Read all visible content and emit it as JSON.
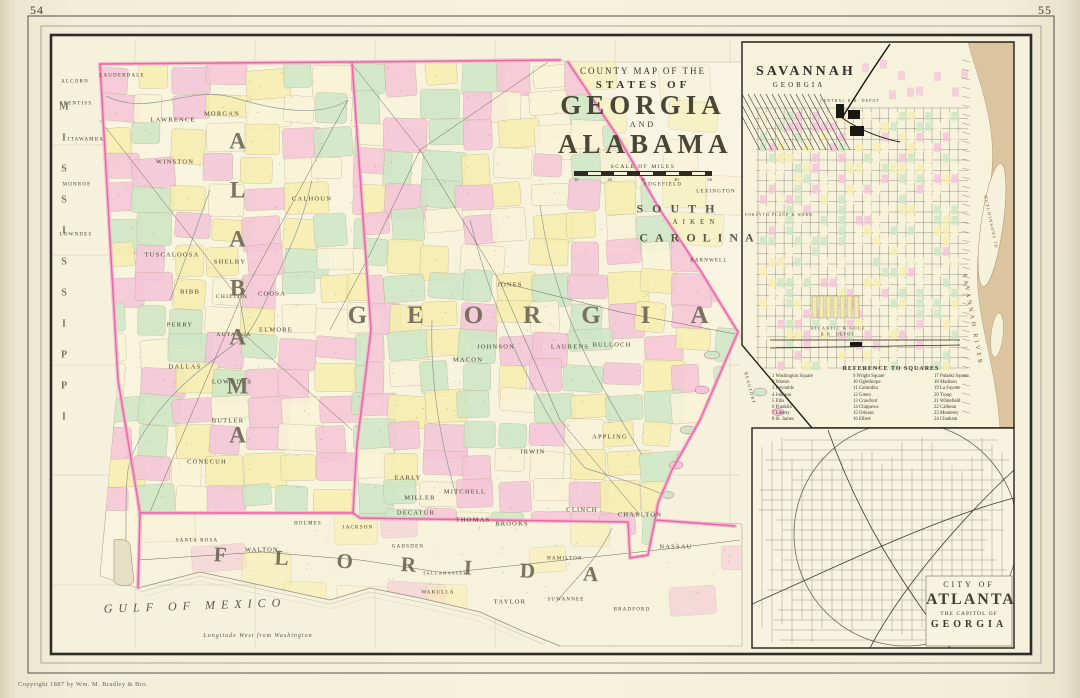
{
  "page": {
    "left_number": "54",
    "right_number": "55",
    "copyright": "Copyright 1887 by Wm. M. Bradley & Bro."
  },
  "title_block": {
    "kicker": "COUNTY MAP OF THE",
    "states_of": "STATES OF",
    "state1": "GEORGIA",
    "and_word": "AND",
    "state2": "ALABAMA",
    "scale_label": "SCALE OF MILES",
    "scale_ticks": [
      "10",
      "20",
      "30",
      "40",
      "50"
    ]
  },
  "savannah_inset": {
    "title": "SAVANNAH",
    "subtitle": "GEORGIA",
    "reference": {
      "title": "REFERENCE TO SQUARES",
      "columns": [
        [
          "1 Washington Square",
          "2 Warren",
          "3 Reynolds",
          "4 Johnson",
          "5 Ellis",
          "6 Franklin",
          "7 Liberty",
          "8 St. James"
        ],
        [
          "9 Wright Square",
          "10 Oglethorpe",
          "11 Columbia",
          "12 Green",
          "13 Crawford",
          "14 Chippewa",
          "15 Orleans",
          "16 Elbert"
        ],
        [
          "17 Pulaski Square",
          "18 Madison",
          "19 La Fayette",
          "20 Troup",
          "21 Whitefield",
          "22 Calhoun",
          "23 Monterey",
          "24 Chatham"
        ]
      ]
    }
  },
  "atlanta_inset": {
    "line1": "CITY OF",
    "line2": "ATLANTA",
    "line3": "THE CAPITOL OF",
    "line4": "GEORGIA"
  },
  "colors": {
    "state_border_core": "#e75f9f",
    "state_border_glow": "#f3b1cd",
    "county_pink": "#f4c6d8",
    "county_green": "#cfe7c6",
    "county_yellow": "#f6eeb0",
    "county_cream": "#f9f3d8",
    "paper": "#f6f1dc",
    "river_tan": "#d8bd95"
  },
  "labels": {
    "main": [
      {
        "t": "ALCORN",
        "x": 75,
        "y": 82,
        "fs": 5
      },
      {
        "t": "PRENTISS",
        "x": 76,
        "y": 104,
        "fs": 5
      },
      {
        "t": "ITAWAMBA",
        "x": 86,
        "y": 140,
        "fs": 5
      },
      {
        "t": "MONROE",
        "x": 77,
        "y": 185,
        "fs": 5
      },
      {
        "t": "LOWNDES",
        "x": 76,
        "y": 235,
        "fs": 5
      },
      {
        "t": "MISSISSIPPI",
        "x": 64,
        "y": 272,
        "fs": 10,
        "ls": 20,
        "cls": "vert state"
      },
      {
        "t": "LAUDERDALE",
        "x": 122,
        "y": 76,
        "fs": 5
      },
      {
        "t": "LAWRENCE",
        "x": 173,
        "y": 120
      },
      {
        "t": "MORGAN",
        "x": 222,
        "y": 114
      },
      {
        "t": "WINSTON",
        "x": 175,
        "y": 162
      },
      {
        "t": "CALHOUN",
        "x": 312,
        "y": 199
      },
      {
        "t": "TUSCALOOSA",
        "x": 172,
        "y": 255
      },
      {
        "t": "SHELBY",
        "x": 230,
        "y": 262
      },
      {
        "t": "BIBB",
        "x": 190,
        "y": 292
      },
      {
        "t": "COOSA",
        "x": 272,
        "y": 294
      },
      {
        "t": "CHILTON",
        "x": 232,
        "y": 297,
        "fs": 5.5
      },
      {
        "t": "PERRY",
        "x": 180,
        "y": 325
      },
      {
        "t": "AUTAUGA",
        "x": 234,
        "y": 335,
        "fs": 5.5
      },
      {
        "t": "ELMORE",
        "x": 276,
        "y": 330
      },
      {
        "t": "DALLAS",
        "x": 185,
        "y": 367
      },
      {
        "t": "LOWNDES",
        "x": 232,
        "y": 382
      },
      {
        "t": "BUTLER",
        "x": 228,
        "y": 421
      },
      {
        "t": "CONECUH",
        "x": 207,
        "y": 462
      },
      {
        "t": "ALABAMA",
        "x": 237,
        "y": 300,
        "fs": 23,
        "ls": 24,
        "cls": "vert state"
      },
      {
        "t": "JONES",
        "x": 510,
        "y": 285
      },
      {
        "t": "JOHNSON",
        "x": 496,
        "y": 347
      },
      {
        "t": "LAURENS",
        "x": 570,
        "y": 347
      },
      {
        "t": "MACON",
        "x": 468,
        "y": 360
      },
      {
        "t": "BULLOCH",
        "x": 612,
        "y": 345
      },
      {
        "t": "IRWIN",
        "x": 533,
        "y": 452
      },
      {
        "t": "APPLING",
        "x": 610,
        "y": 437
      },
      {
        "t": "EARLY",
        "x": 408,
        "y": 478
      },
      {
        "t": "MILLER",
        "x": 420,
        "y": 498
      },
      {
        "t": "MITCHELL",
        "x": 465,
        "y": 492
      },
      {
        "t": "DECATUR",
        "x": 416,
        "y": 513
      },
      {
        "t": "THOMAS",
        "x": 473,
        "y": 520
      },
      {
        "t": "BROOKS",
        "x": 512,
        "y": 524
      },
      {
        "t": "CLINCH",
        "x": 582,
        "y": 510
      },
      {
        "t": "CHARLTON",
        "x": 640,
        "y": 515
      },
      {
        "t": "GEORGIA",
        "x": 548,
        "y": 316,
        "fs": 25,
        "ls": 40,
        "cls": "state"
      },
      {
        "t": "EDGEFIELD",
        "x": 663,
        "y": 185,
        "fs": 5
      },
      {
        "t": "LEXINGTON",
        "x": 716,
        "y": 192,
        "fs": 5
      },
      {
        "t": "SOUTH",
        "x": 680,
        "y": 209,
        "fs": 12,
        "ls": 9,
        "cls": "state2"
      },
      {
        "t": "AIKEN",
        "x": 696,
        "y": 222,
        "fs": 7,
        "ls": 5
      },
      {
        "t": "CAROLINA",
        "x": 700,
        "y": 238,
        "fs": 12,
        "ls": 7,
        "cls": "state2"
      },
      {
        "t": "BARNWELL",
        "x": 709,
        "y": 261,
        "fs": 5
      },
      {
        "t": "BEAUFORT",
        "x": 750,
        "y": 388,
        "fs": 4.5,
        "rot": 75
      },
      {
        "t": "SANTA ROSA",
        "x": 197,
        "y": 541,
        "fs": 5
      },
      {
        "t": "WALTON",
        "x": 262,
        "y": 550
      },
      {
        "t": "HOLMES",
        "x": 308,
        "y": 524,
        "fs": 5
      },
      {
        "t": "JACKSON",
        "x": 358,
        "y": 528,
        "fs": 5
      },
      {
        "t": "GADSDEN",
        "x": 408,
        "y": 547,
        "fs": 5
      },
      {
        "t": "HAMILTON",
        "x": 565,
        "y": 559,
        "fs": 5
      },
      {
        "t": "TALLAHASSEE",
        "x": 445,
        "y": 573,
        "fs": 4.5
      },
      {
        "t": "WAKULLA",
        "x": 438,
        "y": 593,
        "fs": 5
      },
      {
        "t": "TAYLOR",
        "x": 510,
        "y": 602
      },
      {
        "t": "SUWANNEE",
        "x": 566,
        "y": 600,
        "fs": 5
      },
      {
        "t": "BRADFORD",
        "x": 632,
        "y": 610,
        "fs": 5
      },
      {
        "t": "NASSAU",
        "x": 676,
        "y": 547
      },
      {
        "t": "FLORIDA",
        "x": 430,
        "y": 566,
        "fs": 21,
        "ls": 48,
        "cls": "state",
        "rot": 3
      },
      {
        "t": "GULF OF MEXICO",
        "x": 195,
        "y": 606,
        "fs": 12,
        "ls": 6,
        "cls": "water",
        "rot": -2
      },
      {
        "t": "Longitude West from Washington",
        "x": 258,
        "y": 636,
        "fs": 6,
        "cls": "water"
      }
    ],
    "savannah": [
      {
        "t": "CENTRAL R.R. DEPOT",
        "x": 850,
        "y": 101,
        "fs": 3.8
      },
      {
        "t": "FORSYTH PLACE & WARD",
        "x": 779,
        "y": 215,
        "fs": 3.6
      },
      {
        "t": "ATLANTIC & GULF",
        "x": 838,
        "y": 328,
        "fs": 4.2
      },
      {
        "t": "R.R. DEPOT",
        "x": 838,
        "y": 334,
        "fs": 4.2
      },
      {
        "t": "HUTCHINSONS ID",
        "x": 991,
        "y": 222,
        "fs": 4.5,
        "rot": 78,
        "col": "#6b5134"
      },
      {
        "t": "SAVANNAH RIVER",
        "x": 972,
        "y": 320,
        "fs": 6,
        "ls": 3,
        "rot": 80,
        "col": "#6b5134"
      }
    ]
  }
}
